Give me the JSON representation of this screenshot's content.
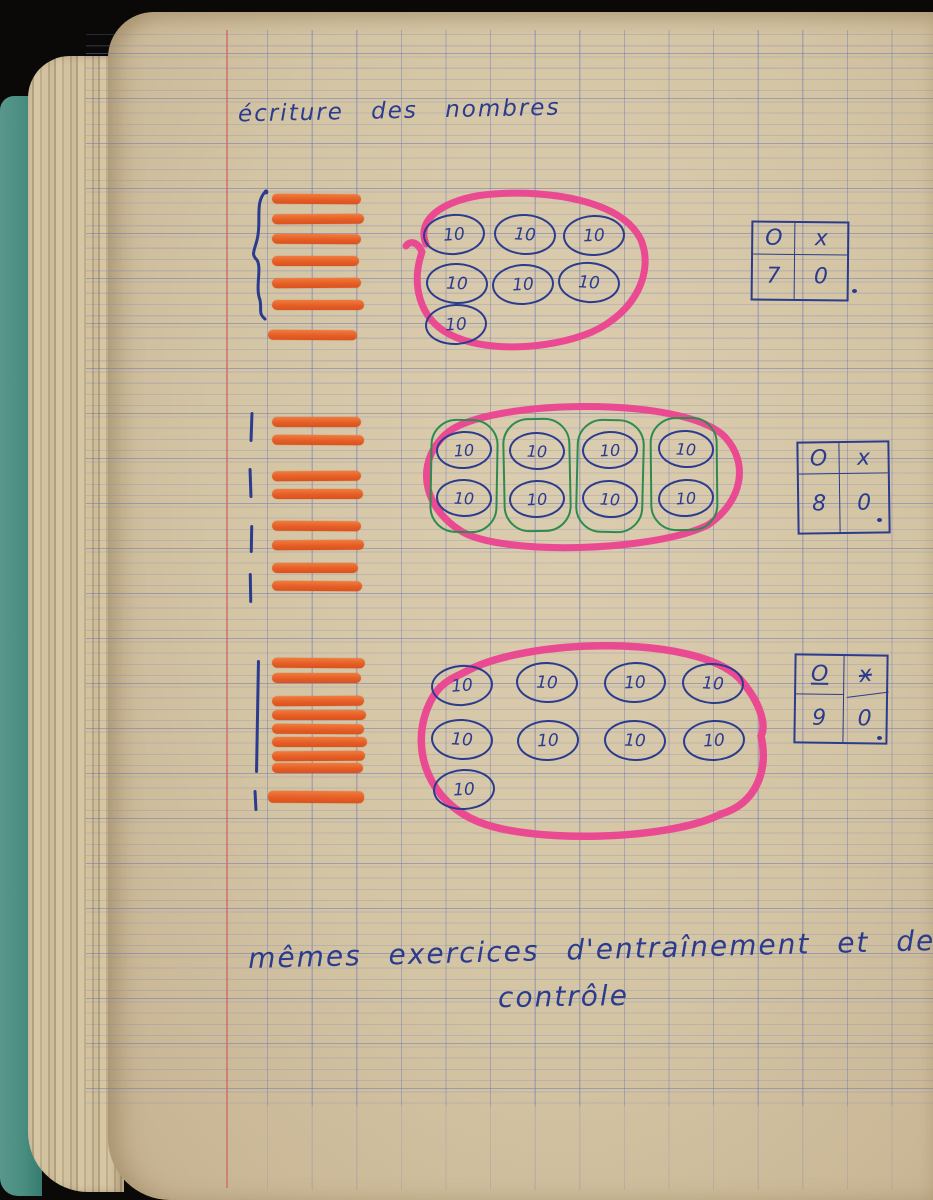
{
  "page": {
    "title": "écriture des nombres",
    "footer_line1": "mêmes exercices d'entraînement et de",
    "footer_line2": "contrôle"
  },
  "labels": {
    "ten": "10"
  },
  "groups": [
    {
      "name": "seventy",
      "tally_bars": 7,
      "ten_circles": 7,
      "table": {
        "headers": [
          "O",
          "x"
        ],
        "values": [
          "7",
          "0"
        ]
      }
    },
    {
      "name": "eighty",
      "tally_bars": 8,
      "ten_circles": 8,
      "green_subgroups": 4,
      "table": {
        "headers": [
          "O",
          "x"
        ],
        "values": [
          "8",
          "0"
        ]
      }
    },
    {
      "name": "ninety",
      "tally_bars": 9,
      "ten_circles": 9,
      "table": {
        "headers": [
          "O",
          "x"
        ],
        "values": [
          "9",
          "0"
        ]
      }
    }
  ],
  "colors": {
    "ink": "#2b3b8e",
    "orange_marker": "#e8612c",
    "pink_marker": "#ea4a92",
    "green_pen": "#2e8b50",
    "paper": "#d2c3a4",
    "ruling": "#7d85bd",
    "margin_line": "#cc6b6b",
    "cover": "#4d8d82"
  }
}
